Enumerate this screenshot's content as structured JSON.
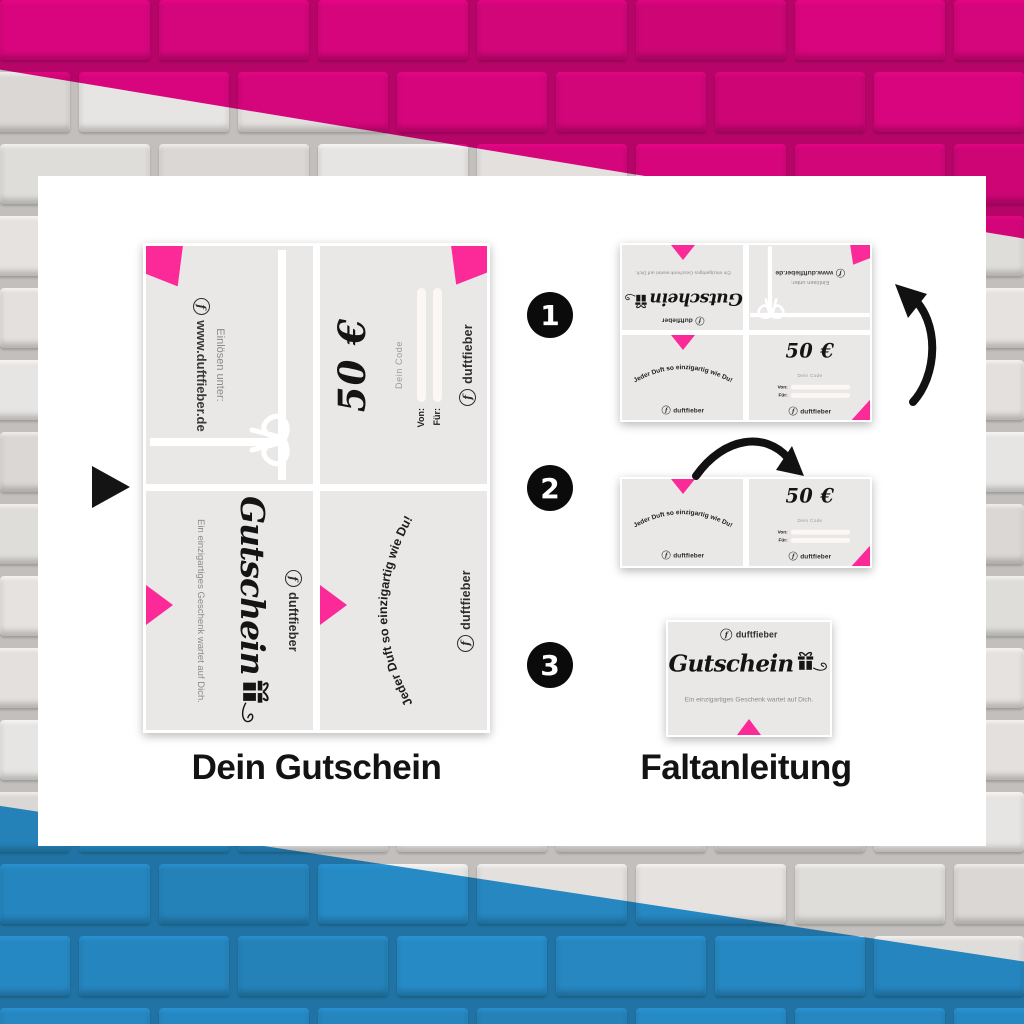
{
  "captions": {
    "left": "Dein Gutschein",
    "right": "Faltanleitung"
  },
  "brand": {
    "name": "duftfieber",
    "logo_letter": "f"
  },
  "voucher": {
    "amount": "50 €",
    "code_label": "Dein Code",
    "from_label": "Von:",
    "for_label": "Für:",
    "redeem_line1": "Einlösen unter:",
    "redeem_line2": "www.duftfieber.de",
    "title": "Gutschein",
    "subtitle": "Ein einzigartiges Geschenk wartet auf Dich.",
    "slogan": "Jeder Duft so einzigartig wie Du!"
  },
  "steps": [
    {
      "number": "1"
    },
    {
      "number": "2"
    },
    {
      "number": "3"
    }
  ],
  "colors": {
    "wall_magenta": "#e6007e",
    "wall_blue": "#2395d6",
    "wall_gray": "#dedcda",
    "accent_pink": "#fb2a98",
    "panel_gray": "#e9e8e7"
  }
}
